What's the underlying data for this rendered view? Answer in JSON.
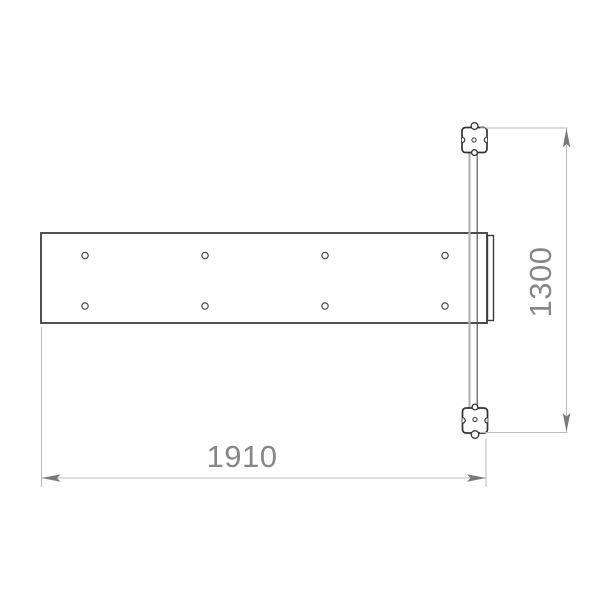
{
  "drawing": {
    "kind": "technical-drawing-top-view",
    "dim_width": {
      "label": "1910"
    },
    "dim_height": {
      "label": "1300"
    },
    "plate": {
      "hole_count": 8,
      "hole_rows": 2,
      "hole_columns": 4
    },
    "colors": {
      "outline": "#3d3d3d",
      "block_outline": "#333333",
      "bar_hidden_line": "#b3b3b3",
      "bar_edge_line": "#4a4a4a",
      "dim_line": "#bdbdbd",
      "dim_text": "#878787",
      "arrow": "#7a7a7a",
      "background": "#ffffff"
    }
  }
}
